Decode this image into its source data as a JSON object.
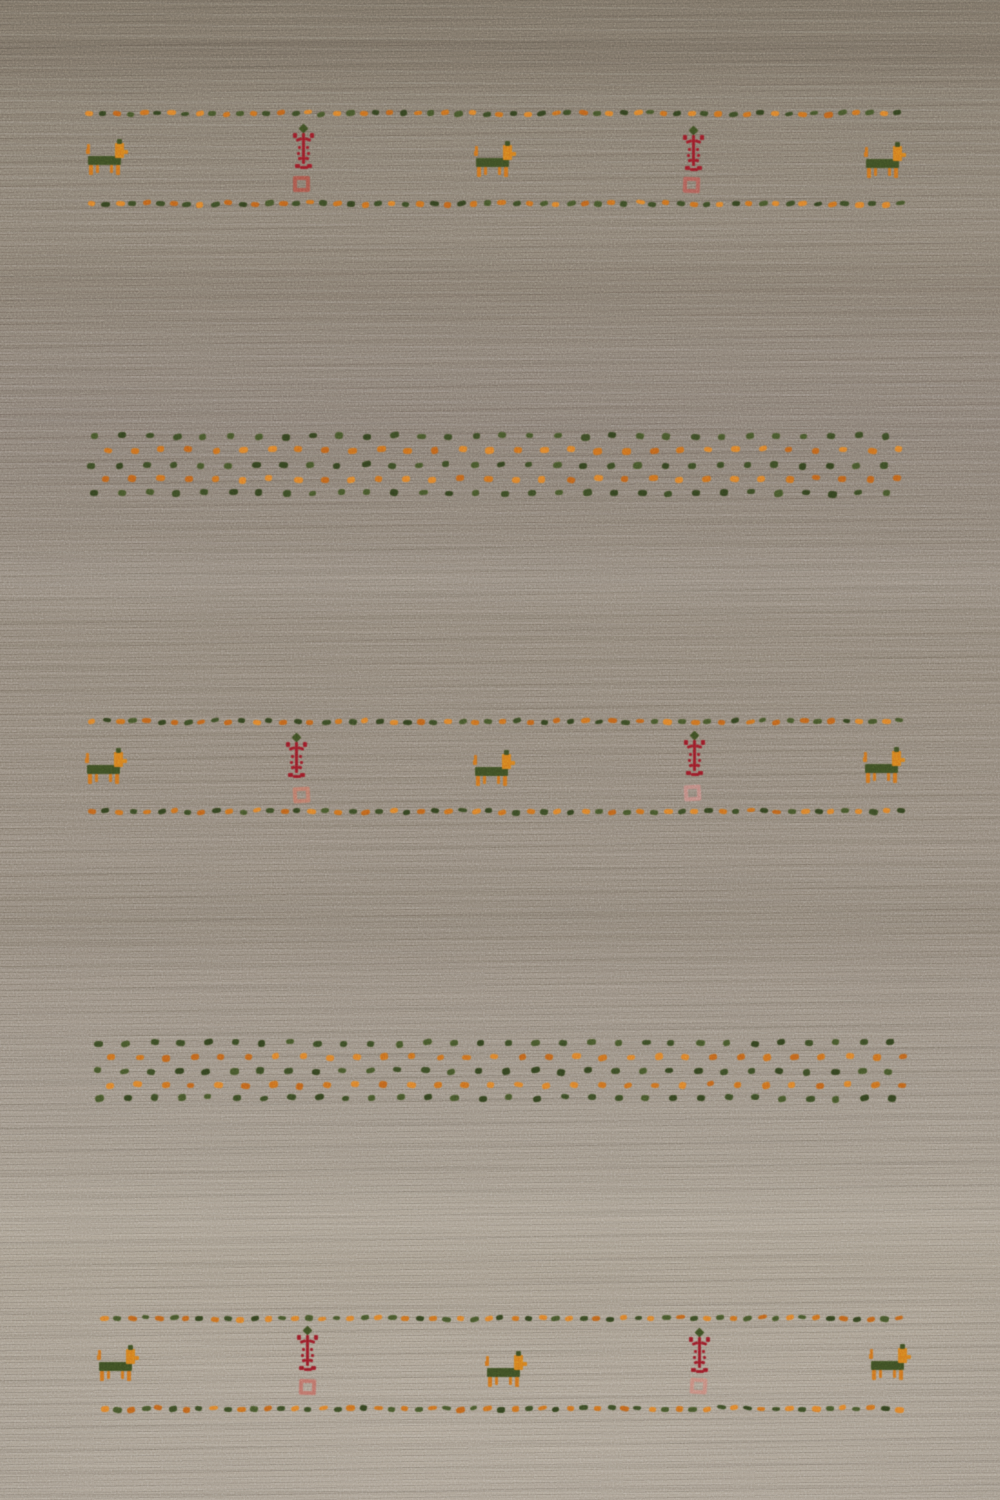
{
  "meta": {
    "subject": "Hand-knotted Gabbeh style wool area rug photographed flat from above",
    "field": "beige-taupe wool field with horizontal weave striations, darker at top, lighter at bottom",
    "motifs": "three horizontal bands bounded by dotted guard lines containing stylized animal, tree and square medallion motifs, plus two bands of scattered polka dots"
  },
  "palette": {
    "field_top": "#7e7568",
    "field_bottom": "#b5ab9d",
    "green": "#3e4f24",
    "green_variants": [
      "#3c4c26",
      "#344320",
      "#47572c"
    ],
    "orange": "#d2741f",
    "orange_bright": "#d8801f",
    "orange_variants": [
      "#cf7120",
      "#c2641c",
      "#e0832c"
    ],
    "crimson": "#9c1c28",
    "salmon": "#bf7c6b"
  },
  "dot_line": {
    "spacing": 13.7,
    "dot_w": 8,
    "dot_h": 5
  },
  "scatter": {
    "spacing": 27.3,
    "dot_w": 8,
    "dot_h": 6
  },
  "bands": [
    {
      "name": "top",
      "line_top": {
        "y": 111,
        "x1": 85,
        "x2": 906
      },
      "line_bottom": {
        "y": 201,
        "x1": 87,
        "x2": 906
      },
      "animals": [
        {
          "x": 86,
          "y": 138
        },
        {
          "x": 474,
          "y": 140
        },
        {
          "x": 864,
          "y": 141
        }
      ],
      "trees": [
        {
          "x": 291,
          "y": 124
        },
        {
          "x": 681,
          "y": 126
        }
      ],
      "squares": [
        {
          "x": 293,
          "y": 176,
          "color": "#ad584c"
        },
        {
          "x": 683,
          "y": 177,
          "color": "#b3625a"
        }
      ]
    },
    {
      "name": "middle",
      "line_top": {
        "y": 719,
        "x1": 88,
        "x2": 903
      },
      "line_bottom": {
        "y": 809,
        "x1": 88,
        "x2": 902
      },
      "animals": [
        {
          "x": 85,
          "y": 747
        },
        {
          "x": 473,
          "y": 749
        },
        {
          "x": 863,
          "y": 746
        }
      ],
      "trees": [
        {
          "x": 284,
          "y": 733
        },
        {
          "x": 682,
          "y": 731
        }
      ],
      "squares": [
        {
          "x": 293,
          "y": 787,
          "color": "#bf7c6b"
        },
        {
          "x": 684,
          "y": 785,
          "color": "#c48d85"
        }
      ]
    },
    {
      "name": "bottom",
      "line_top": {
        "y": 1316,
        "x1": 100,
        "x2": 903
      },
      "line_bottom": {
        "y": 1406,
        "x1": 100,
        "x2": 905
      },
      "animals": [
        {
          "x": 97,
          "y": 1344
        },
        {
          "x": 485,
          "y": 1350
        },
        {
          "x": 869,
          "y": 1343
        }
      ],
      "trees": [
        {
          "x": 295,
          "y": 1326
        },
        {
          "x": 687,
          "y": 1328
        }
      ],
      "squares": [
        {
          "x": 299,
          "y": 1379,
          "color": "#c0746a"
        },
        {
          "x": 690,
          "y": 1378,
          "color": "#c98d80"
        }
      ]
    }
  ],
  "scatter_bands": [
    {
      "x_end": 901,
      "rows": [
        {
          "y": 433,
          "color": "green",
          "x": 90
        },
        {
          "y": 447,
          "color": "orange",
          "x": 103
        },
        {
          "y": 462,
          "color": "green",
          "x": 88
        },
        {
          "y": 476,
          "color": "orange",
          "x": 102
        },
        {
          "y": 490,
          "color": "green",
          "x": 91
        }
      ]
    },
    {
      "x_end": 901,
      "rows": [
        {
          "y": 1040,
          "color": "green",
          "x": 95
        },
        {
          "y": 1054,
          "color": "orange",
          "x": 108
        },
        {
          "y": 1068,
          "color": "green",
          "x": 93
        },
        {
          "y": 1082,
          "color": "orange",
          "x": 106
        },
        {
          "y": 1095,
          "color": "green",
          "x": 96
        }
      ]
    }
  ]
}
